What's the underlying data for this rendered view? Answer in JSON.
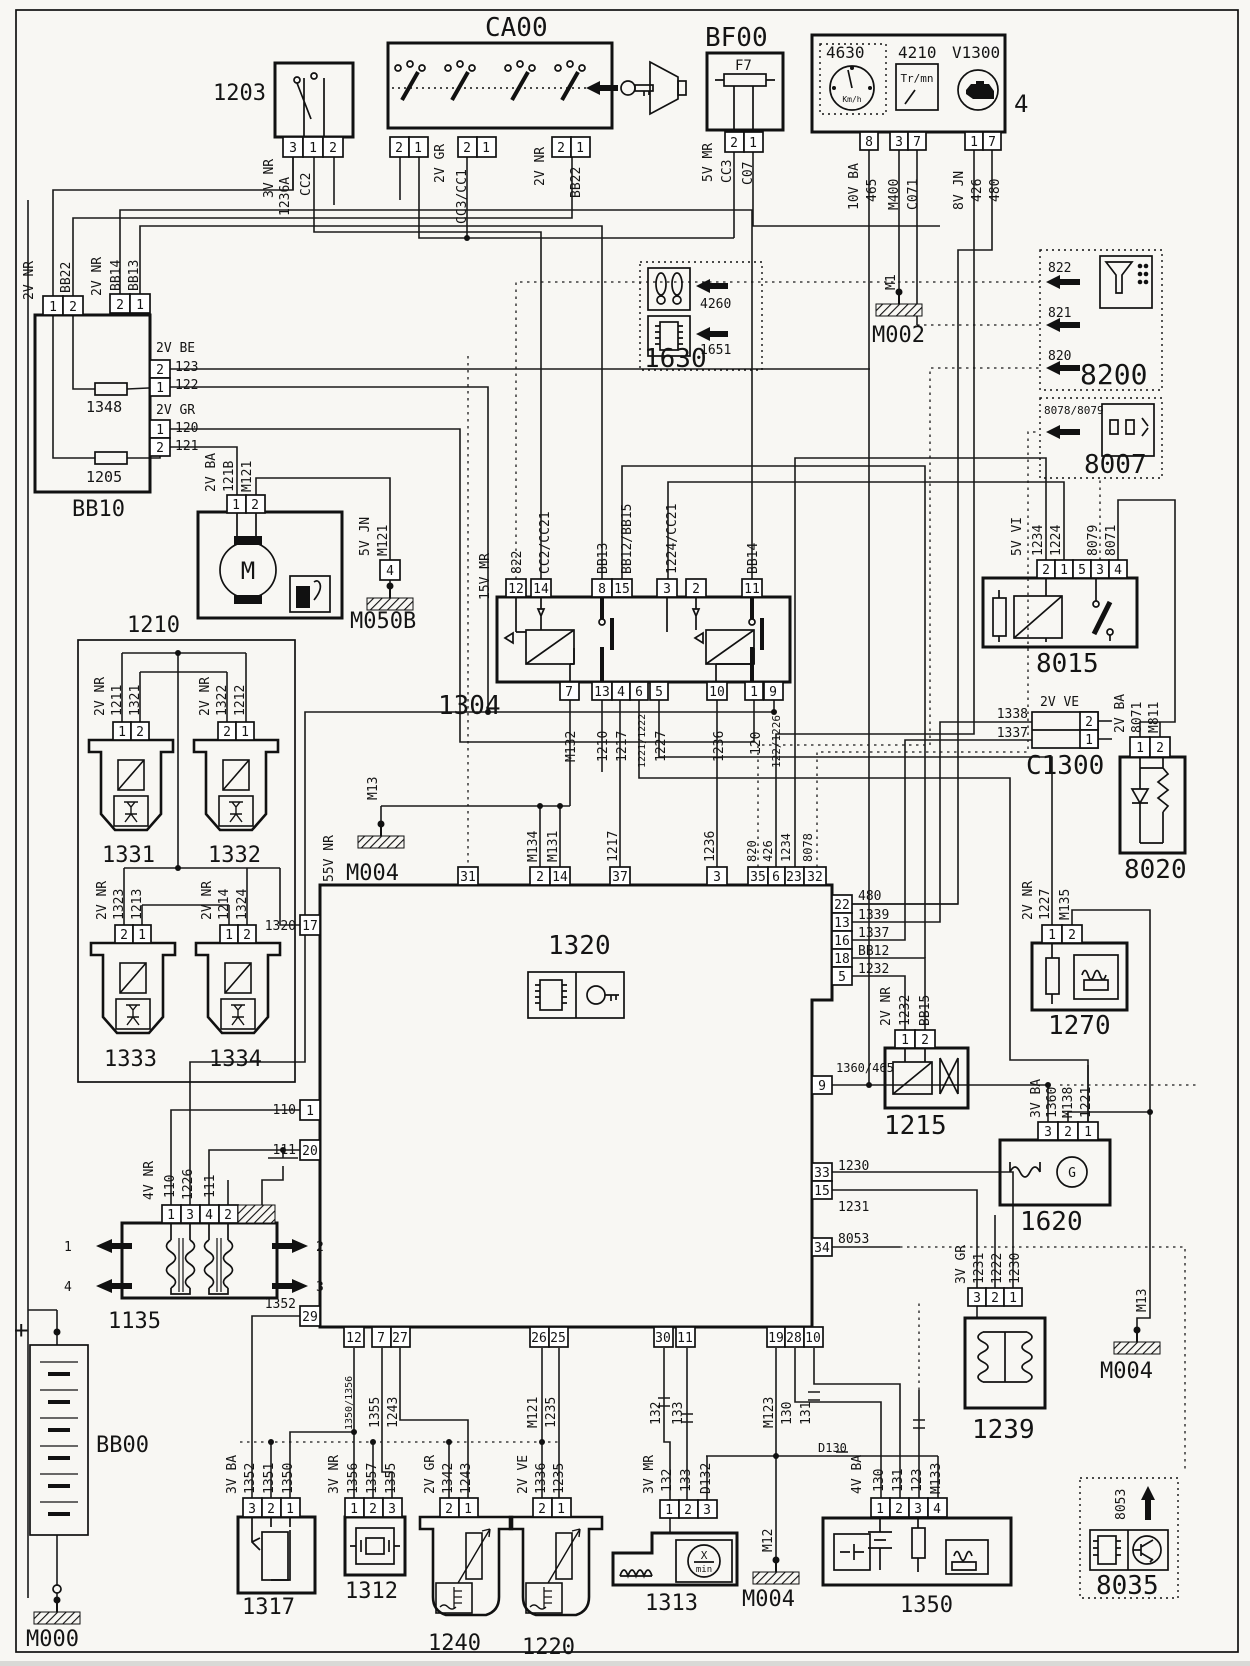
{
  "c": {
    "b1203": {
      "ref": "1203",
      "pins": [
        "3",
        "1",
        "2"
      ],
      "w": [
        "3V NR",
        "1236A",
        "CC2"
      ]
    },
    "ca00": {
      "ref": "CA00",
      "pins": [
        "2",
        "1",
        "2",
        "1",
        "2",
        "1"
      ],
      "w": [
        "2V GR",
        "CC3/CC1",
        "2V NR",
        "BB22"
      ]
    },
    "bf00": {
      "ref": "BF00",
      "fuse": "F7",
      "pins": [
        "2",
        "1"
      ],
      "w": [
        "5V MR",
        "CC3",
        "C07"
      ]
    },
    "clu": {
      "ref4630": "4630",
      "ref4210": "4210",
      "refv": "V1300",
      "kmh": "Km/h",
      "trmn": "Tr/mn",
      "pins": [
        "8",
        "3",
        "7",
        "1",
        "7"
      ],
      "w": [
        "10V BA",
        "465",
        "M400",
        "C071",
        "8V JN",
        "426",
        "480"
      ],
      "four": "4"
    },
    "m002": {
      "ref": "M002",
      "w": "M1"
    },
    "g1630": {
      "ref": "1630",
      "a1": "4260",
      "a2": "1651"
    },
    "g8200": {
      "ref": "8200",
      "a1": "822",
      "a2": "821",
      "a3": "820"
    },
    "g8007": {
      "ref": "8007",
      "a1": "8078/8079"
    },
    "bb10": {
      "ref": "BB10",
      "f1": "1348",
      "f2": "1205",
      "p": [
        "1",
        "2",
        "2",
        "1",
        "2",
        "1",
        "1",
        "2"
      ],
      "w": [
        "2V NR",
        "BB22",
        "2V NR",
        "BB14",
        "BB13",
        "2V BE",
        "123",
        "122",
        "2V GR",
        "120",
        "121"
      ]
    },
    "b1210": {
      "ref": "1210",
      "pins": [
        "1",
        "2"
      ],
      "w": [
        "2V BA",
        "121B",
        "M121"
      ],
      "m": "M"
    },
    "m050b": {
      "ref": "M050B",
      "pin": "4",
      "w": [
        "5V JN",
        "M121"
      ]
    },
    "b1304": {
      "ref": "1304",
      "rail": "15V MR",
      "pt": [
        "12",
        "14",
        "8",
        "15",
        "3",
        "2",
        "11"
      ],
      "wt": [
        "822",
        "CC2/CC21",
        "BB13",
        "BB12/BB15",
        "1224/CC21",
        "BB14"
      ],
      "pb": [
        "7",
        "13",
        "4",
        "6",
        "5",
        "10",
        "1",
        "9"
      ],
      "wb": [
        "M132",
        "1210",
        "1217",
        "1221/1222",
        "1227",
        "1236",
        "120",
        "122/1226"
      ]
    },
    "i31": {
      "ref": "1331",
      "pins": [
        "1",
        "2"
      ],
      "w": [
        "2V NR",
        "1211",
        "1321"
      ]
    },
    "i32": {
      "ref": "1332",
      "pins": [
        "2",
        "1"
      ],
      "w": [
        "2V NR",
        "1322",
        "1212"
      ]
    },
    "i33": {
      "ref": "1333",
      "pins": [
        "2",
        "1"
      ],
      "w": [
        "2V NR",
        "1323",
        "1213"
      ]
    },
    "i34": {
      "ref": "1334",
      "pins": [
        "1",
        "2"
      ],
      "w": [
        "2V NR",
        "1214",
        "1324"
      ]
    },
    "m004a": {
      "ref": "M004",
      "w": "M13",
      "rail": "55V NR"
    },
    "ecu": {
      "ref": "1320",
      "conn": "1320",
      "pl": [
        "17",
        "1",
        "20",
        "29"
      ],
      "wl": [
        "110",
        "111",
        "1352"
      ],
      "pt": [
        "31",
        "2",
        "14",
        "37",
        "3",
        "35",
        "6",
        "23",
        "32"
      ],
      "wt": [
        "M134",
        "M131",
        "1217",
        "1236",
        "820",
        "426",
        "1234",
        "8078"
      ],
      "pr": [
        "22",
        "13",
        "16",
        "18",
        "5",
        "9",
        "33",
        "15",
        "34"
      ],
      "wr": [
        "480",
        "1339",
        "1337",
        "BB12",
        "1232",
        "1360/465",
        "1230",
        "1231",
        "8053"
      ],
      "pb": [
        "12",
        "7",
        "27",
        "26",
        "25",
        "30",
        "11",
        "19",
        "28",
        "10"
      ],
      "wb": [
        "1350/1356",
        "1355",
        "1243",
        "M121",
        "1235",
        "132",
        "133",
        "M123",
        "130",
        "131"
      ]
    },
    "b8015": {
      "ref": "8015",
      "pins": [
        "2",
        "1",
        "5",
        "3",
        "4"
      ],
      "w": [
        "5V VI",
        "1234",
        "1224",
        "8079",
        "8071"
      ]
    },
    "c1300": {
      "ref": "C1300",
      "pins": [
        "2",
        "1"
      ],
      "w": [
        "1338",
        "1337",
        "2V VE"
      ]
    },
    "b8020": {
      "ref": "8020",
      "pins": [
        "1",
        "2"
      ],
      "w": [
        "2V BA",
        "8071",
        "M811"
      ]
    },
    "b1270": {
      "ref": "1270",
      "pins": [
        "1",
        "2"
      ],
      "w": [
        "2V NR",
        "1227",
        "M135"
      ]
    },
    "b1215": {
      "ref": "1215",
      "pins": [
        "1",
        "2"
      ],
      "w": [
        "2V NR",
        "1232",
        "BB15"
      ]
    },
    "b1620": {
      "ref": "1620",
      "pins": [
        "3",
        "2",
        "1"
      ],
      "w": [
        "3V BA",
        "1360",
        "M138",
        "1221"
      ],
      "g": "G"
    },
    "b1239": {
      "ref": "1239",
      "pins": [
        "3",
        "2",
        "1"
      ],
      "w": [
        "3V GR",
        "1231",
        "1222",
        "1230"
      ]
    },
    "m004b": {
      "ref": "M004",
      "w": "M13"
    },
    "b1135": {
      "ref": "1135",
      "pins": [
        "1",
        "3",
        "4",
        "2"
      ],
      "w": [
        "4V NR",
        "110",
        "1226",
        "111"
      ],
      "a1": "1",
      "a2": "4",
      "a3": "2",
      "a4": "3"
    },
    "bb00": {
      "ref": "BB00",
      "plus": "+",
      "gnd": "M000"
    },
    "b1317": {
      "ref": "1317",
      "pins": [
        "3",
        "2",
        "1"
      ],
      "w": [
        "3V BA",
        "1352",
        "1351",
        "1350"
      ]
    },
    "b1312": {
      "ref": "1312",
      "pins": [
        "1",
        "2",
        "3"
      ],
      "w": [
        "3V NR",
        "1356",
        "1357",
        "1355"
      ]
    },
    "b1240": {
      "ref": "1240",
      "pins": [
        "2",
        "1"
      ],
      "w": [
        "2V GR",
        "1342",
        "1243"
      ]
    },
    "b1220": {
      "ref": "1220",
      "pins": [
        "2",
        "1"
      ],
      "w": [
        "2V VE",
        "1336",
        "1235"
      ]
    },
    "b1313": {
      "ref": "1313",
      "pins": [
        "1",
        "2",
        "3"
      ],
      "w": [
        "3V MR",
        "132",
        "133",
        "D132"
      ],
      "x": "X",
      "min": "min"
    },
    "m004c": {
      "ref": "M004",
      "w": "M12"
    },
    "b1350": {
      "ref": "1350",
      "pins": [
        "1",
        "2",
        "3",
        "4"
      ],
      "w": [
        "4V BA",
        "130",
        "131",
        "123",
        "M133"
      ],
      "sh": "D130"
    },
    "g8035": {
      "ref": "8035",
      "a1": "8053"
    }
  }
}
